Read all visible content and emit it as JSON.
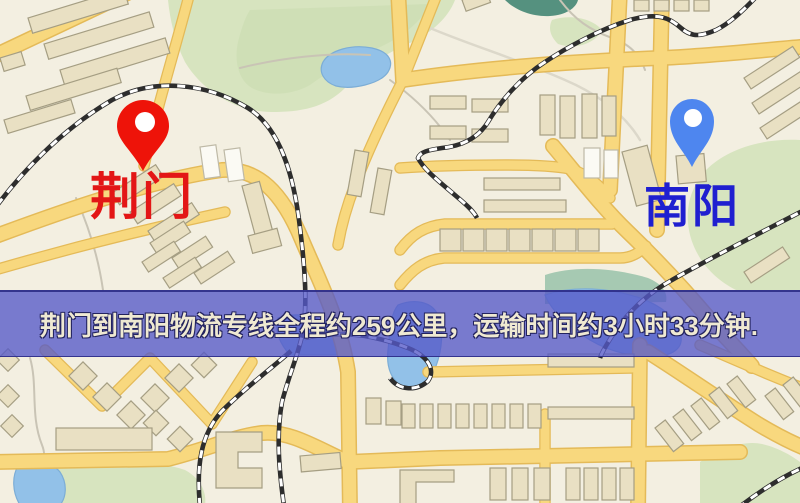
{
  "banner": {
    "text": "荆门到南阳物流专线全程约259公里，运输时间约3小时33分钟."
  },
  "route": {
    "from": "荆门",
    "to": "南阳",
    "distance": "约259公里",
    "duration": "约3小时33分钟"
  },
  "markers": {
    "origin": {
      "label": "荆门"
    },
    "destination": {
      "label": "南阳"
    }
  },
  "colors": {
    "pin-origin": "#ee1309",
    "pin-destination": "#4e86ef",
    "label-origin": "#e31616",
    "label-destination": "#1f1fd0",
    "banner-bg": "rgba(84,88,200,0.78)",
    "banner-border": "rgba(40,40,130,0.85)",
    "banner-text": "#efe9d2",
    "map-background": "#f3efe1",
    "road": "#f8d87e",
    "building": "#e9e0c3",
    "green-area": "#d7e4bf",
    "water": "#92c1e8"
  }
}
